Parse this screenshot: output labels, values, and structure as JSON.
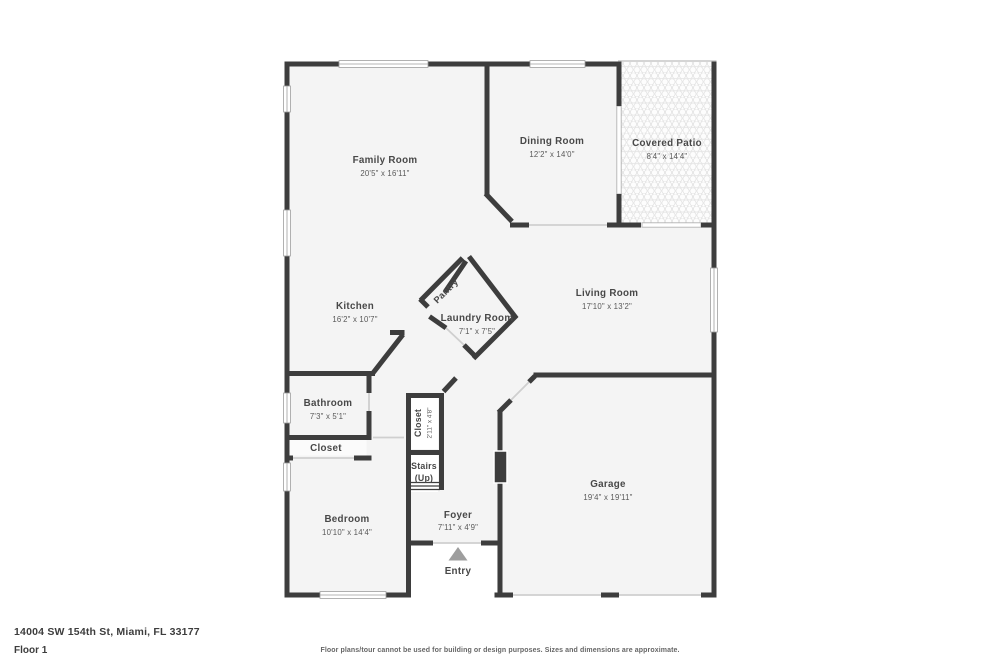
{
  "colors": {
    "wall": "#3d3d3d",
    "floor": "#f4f4f4",
    "label": "#484848",
    "entry_arrow": "#9e9e9e",
    "background": "#ffffff"
  },
  "rooms": {
    "family": {
      "name": "Family Room",
      "dims": "20'5\" x 16'11\""
    },
    "dining": {
      "name": "Dining Room",
      "dims": "12'2\" x 14'0\""
    },
    "patio": {
      "name": "Covered Patio",
      "dims": "8'4\" x 14'4\""
    },
    "kitchen": {
      "name": "Kitchen",
      "dims": "16'2\" x 10'7\""
    },
    "pantry": {
      "name": "Pantry"
    },
    "laundry": {
      "name": "Laundry Room",
      "dims": "7'1\" x 7'5\""
    },
    "living": {
      "name": "Living Room",
      "dims": "17'10\" x 13'2\""
    },
    "bathroom": {
      "name": "Bathroom",
      "dims": "7'3\" x 5'1\""
    },
    "closet_hall": {
      "name": "Closet"
    },
    "closet_foyer": {
      "name": "Closet",
      "dims": "2'11\" x 4'8\""
    },
    "stairs": {
      "name": "Stairs",
      "sub": "(Up)"
    },
    "bedroom": {
      "name": "Bedroom",
      "dims": "10'10\" x 14'4\""
    },
    "foyer": {
      "name": "Foyer",
      "dims": "7'11\" x 4'9\""
    },
    "entry": {
      "name": "Entry"
    },
    "garage": {
      "name": "Garage",
      "dims": "19'4\" x 19'11\""
    }
  },
  "footer": {
    "address": "14004 SW 154th St, Miami, FL 33177",
    "floor_label": "Floor 1",
    "disclaimer": "Floor plans/tour cannot be used for building or design purposes. Sizes and dimensions are approximate."
  }
}
